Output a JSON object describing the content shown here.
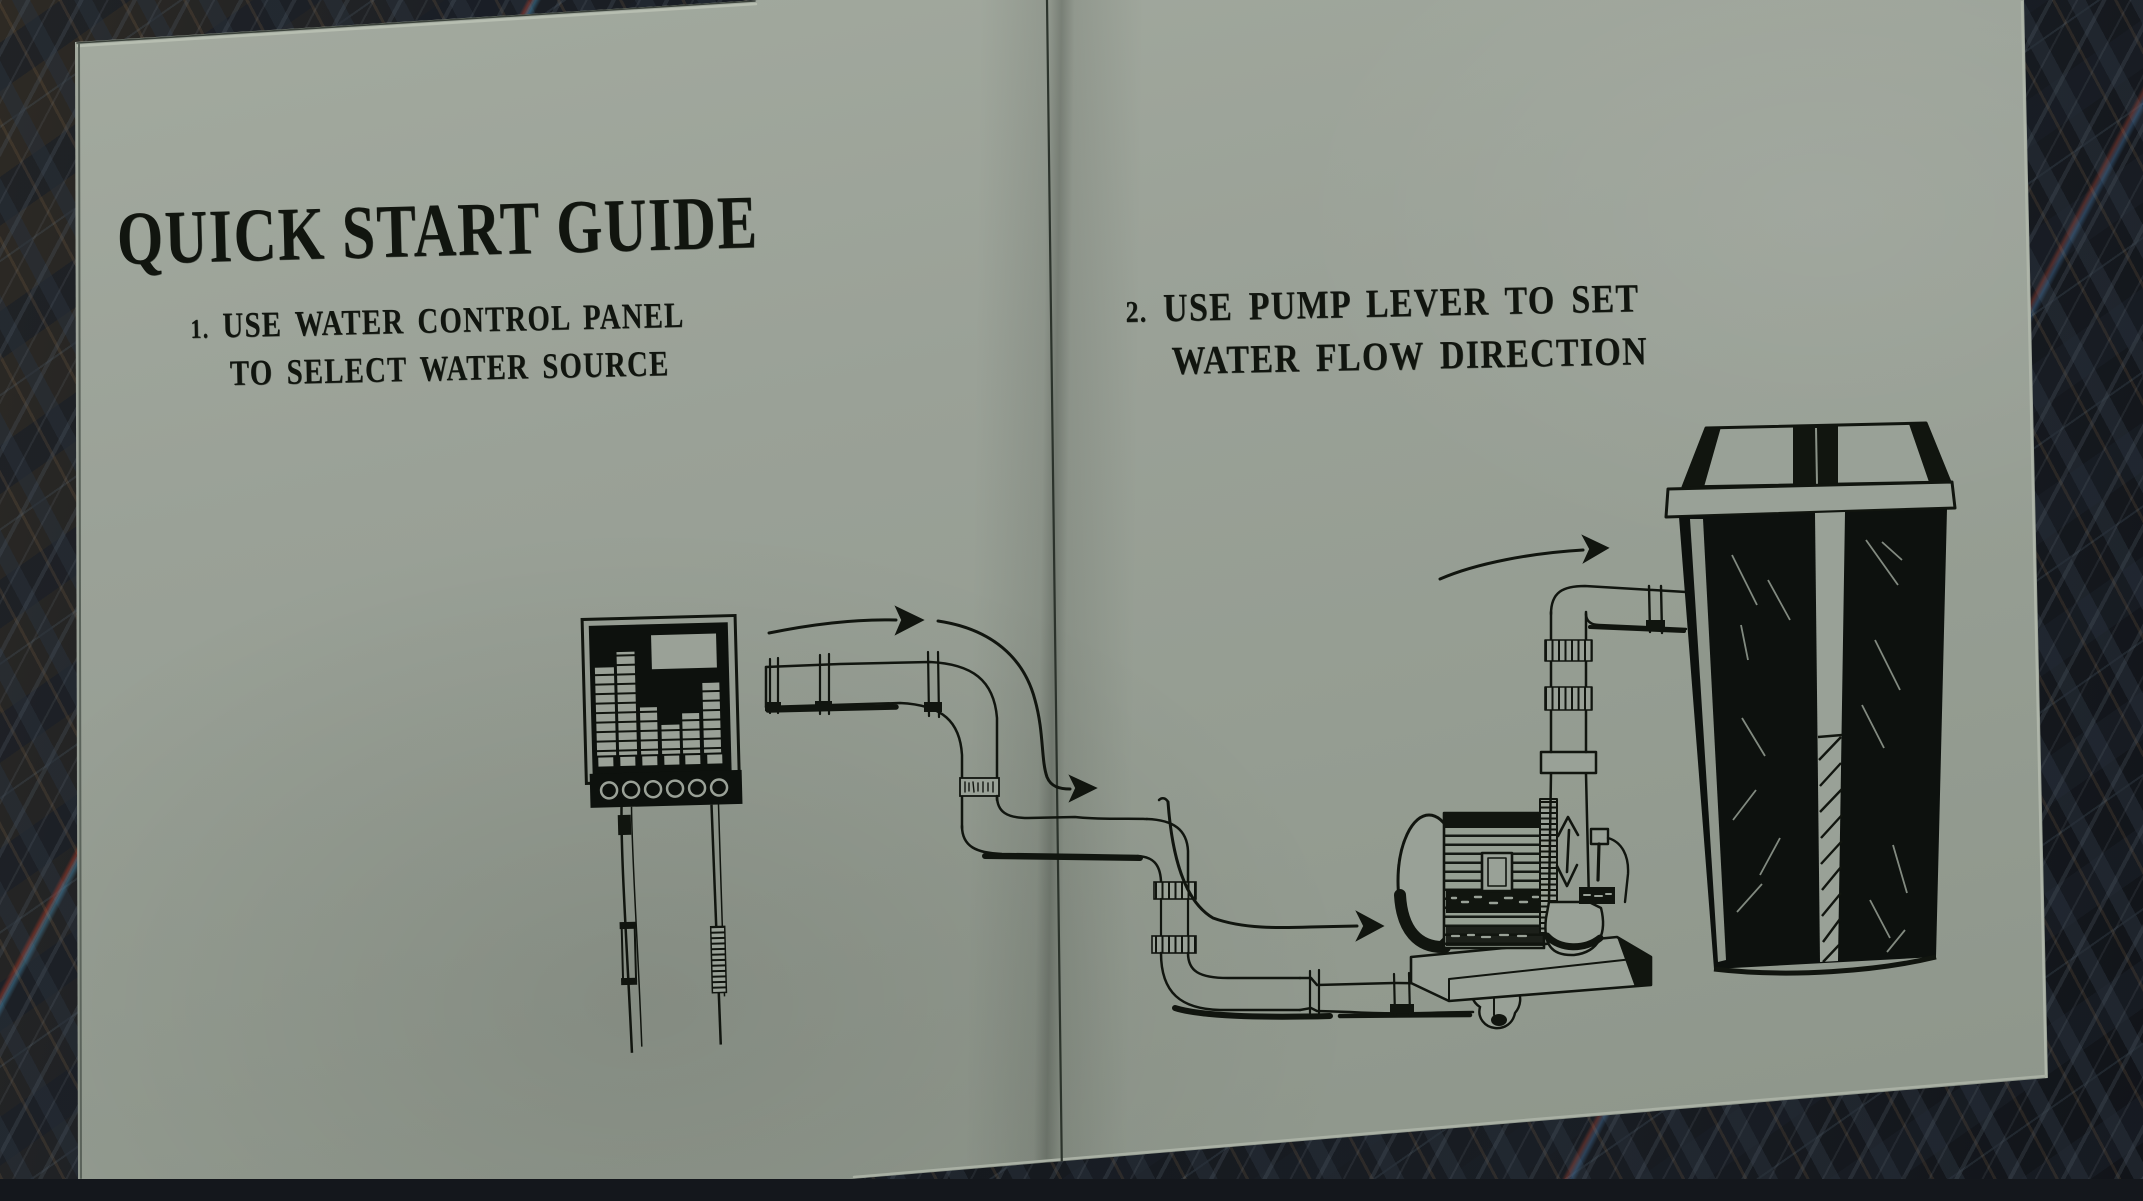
{
  "book": {
    "title": "QUICK START GUIDE",
    "steps": [
      {
        "number": "1.",
        "line1": "USE WATER CONTROL PANEL",
        "line2": "TO SELECT WATER SOURCE"
      },
      {
        "number": "2.",
        "line1": "USE PUMP LEVER TO SET",
        "line2": "WATER FLOW DIRECTION"
      }
    ]
  },
  "colors": {
    "page": "#99a197",
    "ink": "#11150f",
    "background": "#14171c"
  },
  "illustrations": [
    {
      "name": "water-control-panel-illustration",
      "depicts": "wall control panel with level meter columns, screen, six knobs and two hanging cables"
    },
    {
      "name": "pipe-run-illustration",
      "depicts": "flanged water pipe running from panel across the fold down to the pump inlet"
    },
    {
      "name": "pump-illustration",
      "depicts": "centrifugal pump with finned motor, base plate, lever and vertical outlet pipe"
    },
    {
      "name": "water-tank-illustration",
      "depicts": "tall dark water tank with lid, rim and sight-glass level stripe"
    },
    {
      "name": "flow-arrows",
      "depicts": "hand-drawn arrows showing water flow direction, plus up-down arrow on pump outlet"
    }
  ]
}
